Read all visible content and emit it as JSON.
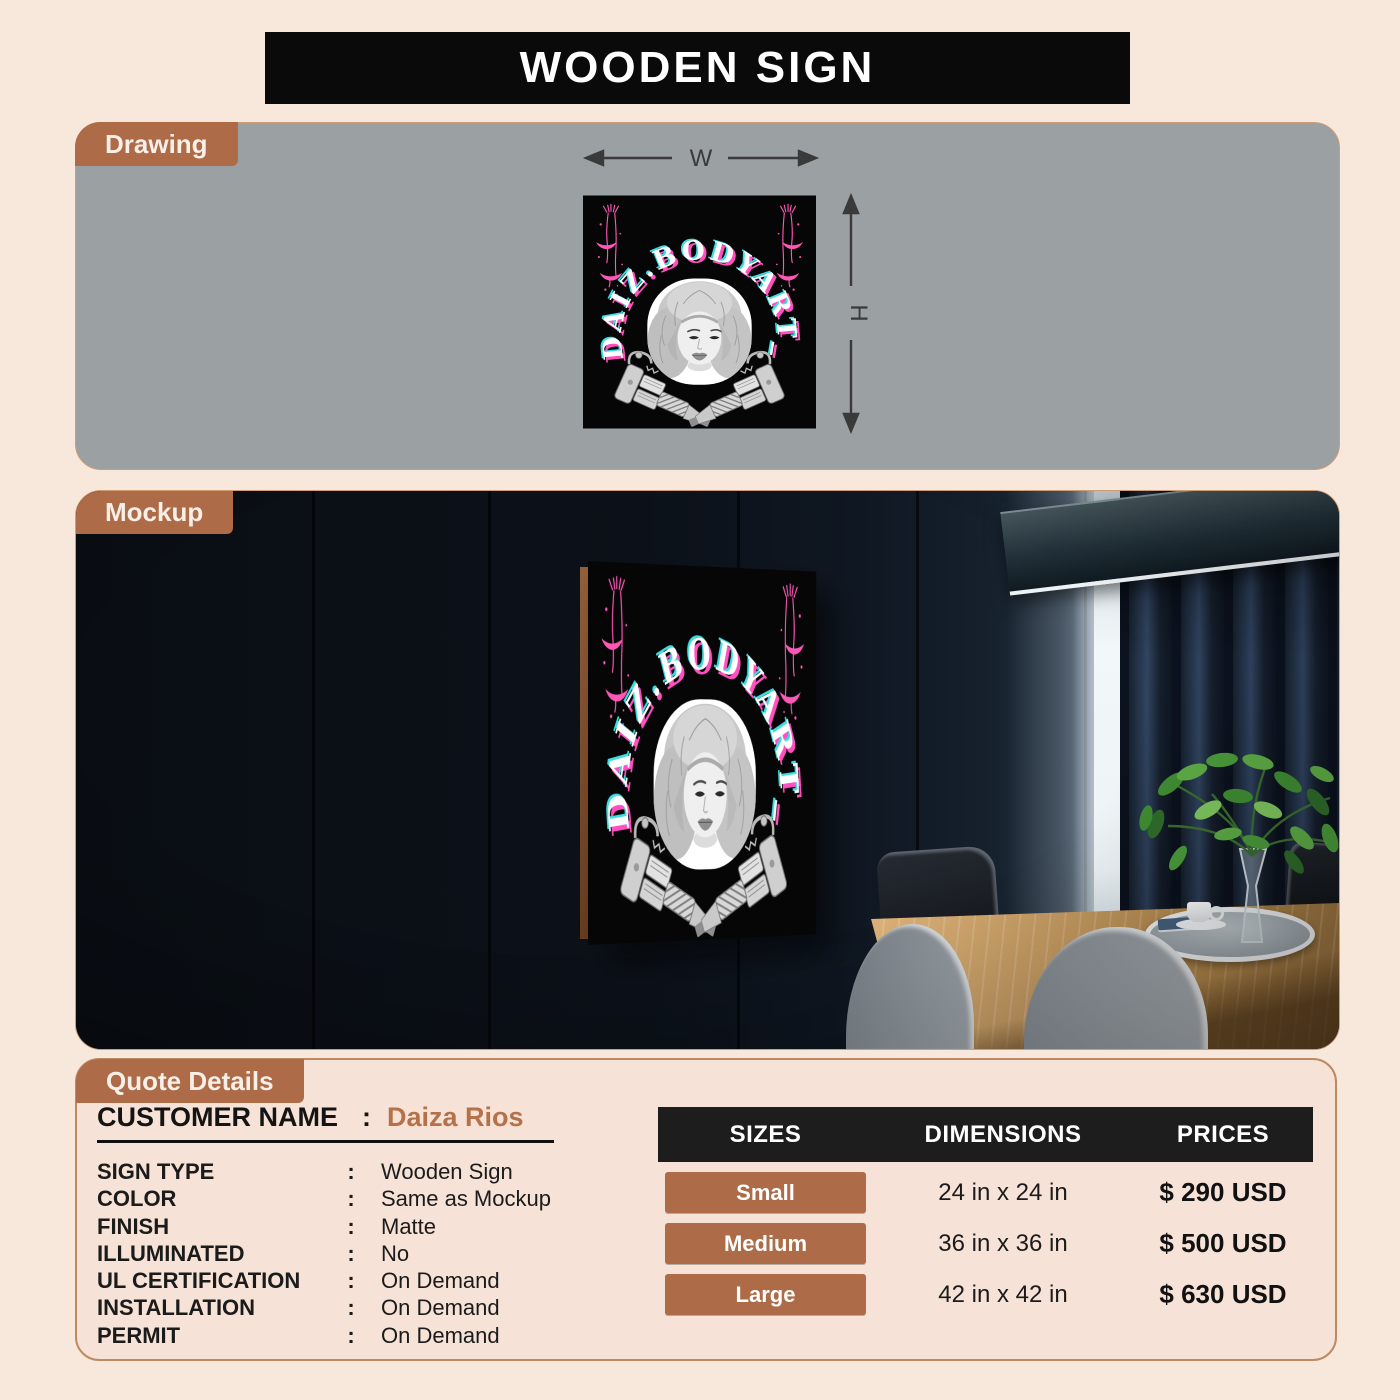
{
  "page": {
    "title": "WOODEN SIGN"
  },
  "drawing": {
    "tab": "Drawing",
    "width_label": "W",
    "height_label": "H"
  },
  "mockup": {
    "tab": "Mockup"
  },
  "sign": {
    "brand_text": "DAIZ.BODYART_"
  },
  "quote": {
    "tab": "Quote Details",
    "separator": ":",
    "customer_label": "CUSTOMER NAME",
    "customer_name": "Daiza Rios",
    "details": [
      {
        "label": "SIGN TYPE",
        "value": "Wooden Sign"
      },
      {
        "label": "COLOR",
        "value": "Same as Mockup"
      },
      {
        "label": "FINISH",
        "value": "Matte"
      },
      {
        "label": "ILLUMINATED",
        "value": "No"
      },
      {
        "label": "UL CERTIFICATION",
        "value": "On Demand"
      },
      {
        "label": "INSTALLATION",
        "value": "On Demand"
      },
      {
        "label": "PERMIT",
        "value": "On Demand"
      }
    ],
    "pricing": {
      "headers": [
        "SIZES",
        "DIMENSIONS",
        "PRICES"
      ],
      "rows": [
        {
          "size": "Small",
          "dimensions": "24 in x 24 in",
          "price": "$ 290 USD"
        },
        {
          "size": "Medium",
          "dimensions": "36 in x 36 in",
          "price": "$ 500 USD"
        },
        {
          "size": "Large",
          "dimensions": "42 in x 42 in",
          "price": "$ 630 USD"
        }
      ]
    }
  },
  "colors": {
    "page_background": "#f8e8dc",
    "accent_brown": "#ad6b47",
    "customer_name_brown": "#b5714a",
    "drawing_panel_gray": "#9ba0a3",
    "header_black": "#0a0a0a",
    "table_header_black": "#1d1d1d",
    "logo_pink": "#ff4fc0",
    "logo_cyan": "#3cdde2",
    "logo_white": "#ffffff"
  }
}
